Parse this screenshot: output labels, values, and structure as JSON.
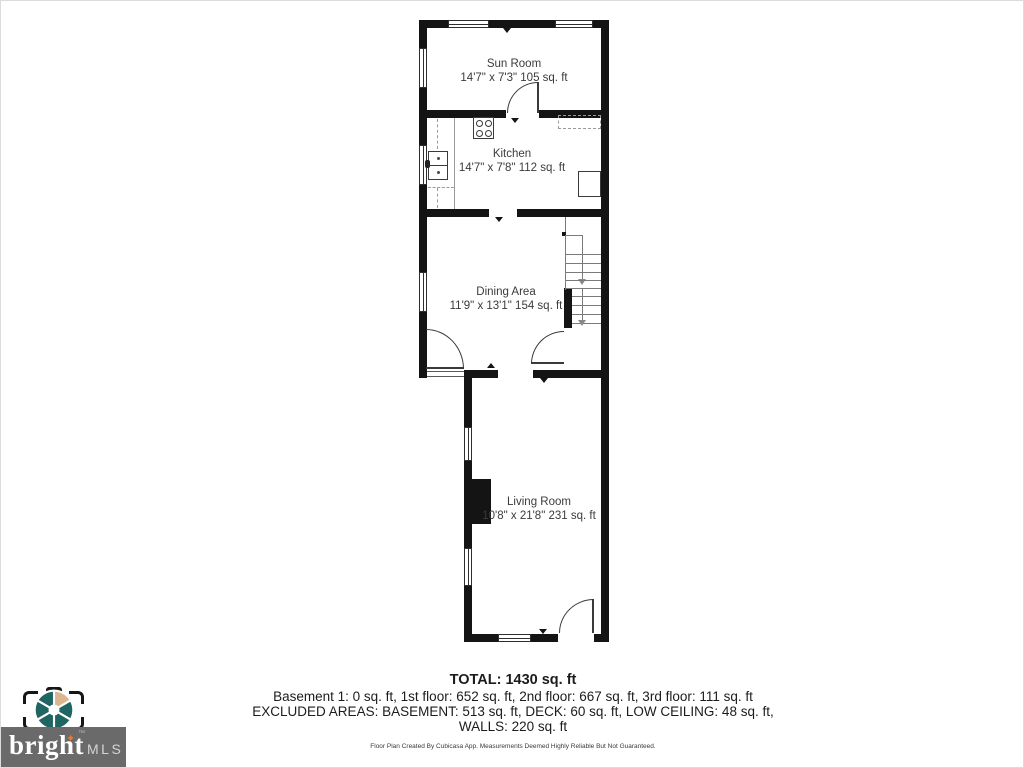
{
  "floor_plan": {
    "rooms": [
      {
        "name": "Sun Room",
        "dims": "14'7\" x 7'3\" 105 sq. ft"
      },
      {
        "name": "Kitchen",
        "dims": "14'7\" x 7'8\" 112 sq. ft"
      },
      {
        "name": "Dining Area",
        "dims": "11'9\" x 13'1\" 154 sq. ft"
      },
      {
        "name": "Living Room",
        "dims": "10'8\" x 21'8\" 231 sq. ft"
      }
    ]
  },
  "summary": {
    "total": "TOTAL: 1430 sq. ft",
    "floors": "Basement 1: 0 sq. ft, 1st floor: 652 sq. ft, 2nd floor: 667 sq. ft, 3rd floor: 111 sq. ft",
    "excluded": "EXCLUDED AREAS: BASEMENT: 513 sq. ft, DECK: 60 sq. ft, LOW CEILING: 48 sq. ft,",
    "walls": "WALLS: 220 sq. ft",
    "disclaimer": "Floor Plan Created By Cubicasa App. Measurements Deemed Highly Reliable But Not Guaranteed."
  },
  "branding": {
    "name": "bright",
    "suffix": "MLS",
    "star": "✦",
    "tm": "™",
    "colors": {
      "aperture_teal": "#1f6561",
      "aperture_tan": "#dbb68f",
      "banner_gray": "#6a6a6a",
      "star_orange": "#e87a2e"
    }
  }
}
